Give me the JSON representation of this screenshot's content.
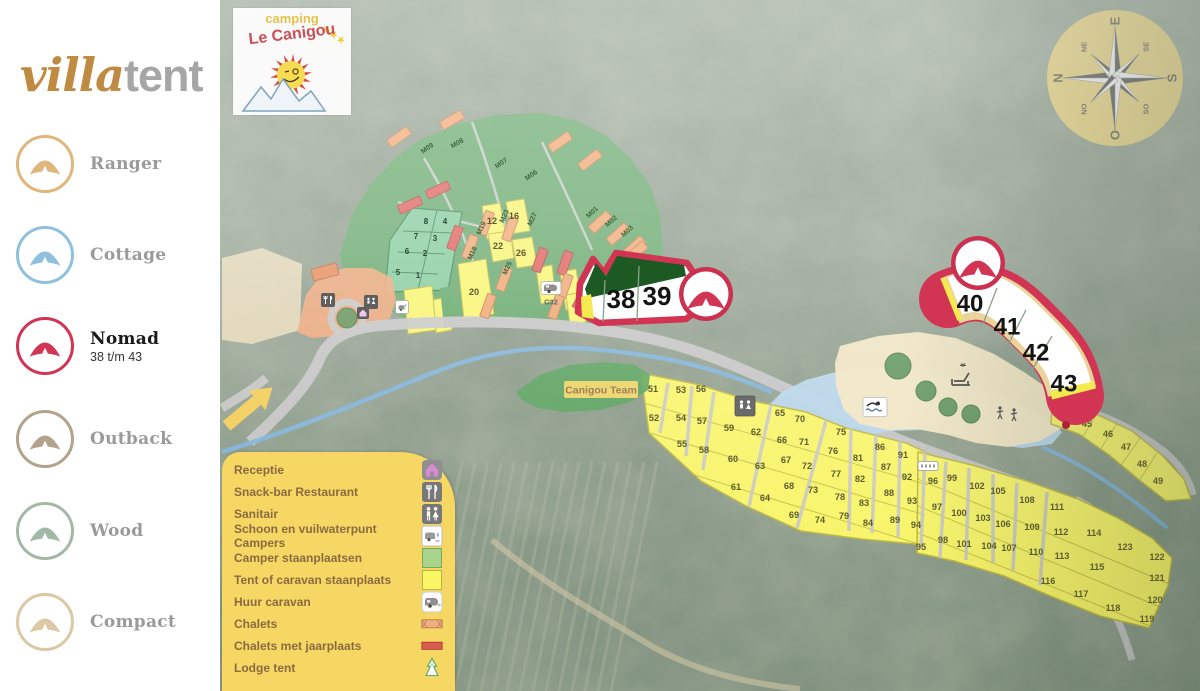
{
  "sidebar": {
    "logo": {
      "villa": "villa",
      "tent": "tent"
    },
    "items": [
      {
        "label": "Ranger",
        "color": "#dfb67c",
        "active": false,
        "sublabel": ""
      },
      {
        "label": "Cottage",
        "color": "#8fc0de",
        "active": false,
        "sublabel": ""
      },
      {
        "label": "Nomad",
        "color": "#d23553",
        "active": true,
        "sublabel": "38 t/m 43"
      },
      {
        "label": "Outback",
        "color": "#b3a28c",
        "active": false,
        "sublabel": ""
      },
      {
        "label": "Wood",
        "color": "#a2b9a7",
        "active": false,
        "sublabel": ""
      },
      {
        "label": "Compact",
        "color": "#dcc8a5",
        "active": false,
        "sublabel": ""
      }
    ]
  },
  "legend": {
    "items": [
      {
        "label": "Receptie",
        "icon": "house"
      },
      {
        "label": "Snack-bar Restaurant",
        "icon": "cutlery"
      },
      {
        "label": "Sanitair",
        "icon": "wc"
      },
      {
        "label": "Schoon en vuilwaterpunt Campers",
        "icon": "camper-service"
      },
      {
        "label": "Camper staanplaatsen",
        "icon": "green-swatch",
        "color": "#a9d48b"
      },
      {
        "label": "Tent of caravan staanplaats",
        "icon": "yellow-swatch",
        "color": "#f8f664"
      },
      {
        "label": "Huur caravan",
        "icon": "caravan"
      },
      {
        "label": "Chalets",
        "icon": "chalet",
        "color": "#f0b084"
      },
      {
        "label": "Chalets met jaarplaats",
        "icon": "chalet-red",
        "color": "#d95b4f"
      },
      {
        "label": "Lodge tent",
        "icon": "lodge"
      }
    ]
  },
  "map_logo": {
    "top": "camping",
    "name": "Le Canigou",
    "stars": "★★★"
  },
  "compass": {
    "cardinals": [
      "N",
      "E",
      "S",
      "O"
    ],
    "diagonals": [
      "NE",
      "SE",
      "SO",
      "NO"
    ]
  },
  "map": {
    "accent_red": "#d23553",
    "canigou_team_label": "Canigou Team",
    "caravan_label": "C32",
    "highlight_plots": [
      {
        "n": "38",
        "x": 621,
        "y": 299
      },
      {
        "n": "39",
        "x": 657,
        "y": 296
      },
      {
        "n": "40",
        "x": 970,
        "y": 303
      },
      {
        "n": "41",
        "x": 1007,
        "y": 326
      },
      {
        "n": "42",
        "x": 1036,
        "y": 352
      },
      {
        "n": "43",
        "x": 1064,
        "y": 383
      }
    ],
    "green_plots": [
      {
        "n": "1",
        "x": 418,
        "y": 275
      },
      {
        "n": "2",
        "x": 425,
        "y": 253
      },
      {
        "n": "3",
        "x": 435,
        "y": 238
      },
      {
        "n": "4",
        "x": 445,
        "y": 221
      },
      {
        "n": "5",
        "x": 398,
        "y": 272
      },
      {
        "n": "6",
        "x": 407,
        "y": 251
      },
      {
        "n": "7",
        "x": 416,
        "y": 236
      },
      {
        "n": "8",
        "x": 426,
        "y": 221
      }
    ],
    "yellow_plots": [
      {
        "n": "12",
        "x": 492,
        "y": 221
      },
      {
        "n": "16",
        "x": 514,
        "y": 216
      },
      {
        "n": "20",
        "x": 474,
        "y": 292
      },
      {
        "n": "22",
        "x": 498,
        "y": 246
      },
      {
        "n": "26",
        "x": 521,
        "y": 253
      },
      {
        "n": "45",
        "x": 1087,
        "y": 424
      },
      {
        "n": "46",
        "x": 1108,
        "y": 434
      },
      {
        "n": "47",
        "x": 1126,
        "y": 447
      },
      {
        "n": "48",
        "x": 1142,
        "y": 464
      },
      {
        "n": "49",
        "x": 1158,
        "y": 481
      },
      {
        "n": "51",
        "x": 653,
        "y": 389
      },
      {
        "n": "52",
        "x": 654,
        "y": 418
      },
      {
        "n": "53",
        "x": 681,
        "y": 390
      },
      {
        "n": "54",
        "x": 681,
        "y": 418
      },
      {
        "n": "55",
        "x": 682,
        "y": 444
      },
      {
        "n": "56",
        "x": 701,
        "y": 389
      },
      {
        "n": "57",
        "x": 702,
        "y": 421
      },
      {
        "n": "58",
        "x": 704,
        "y": 450
      },
      {
        "n": "59",
        "x": 729,
        "y": 428
      },
      {
        "n": "60",
        "x": 733,
        "y": 459
      },
      {
        "n": "61",
        "x": 736,
        "y": 487
      },
      {
        "n": "62",
        "x": 756,
        "y": 432
      },
      {
        "n": "63",
        "x": 760,
        "y": 466
      },
      {
        "n": "64",
        "x": 765,
        "y": 498
      },
      {
        "n": "65",
        "x": 780,
        "y": 413
      },
      {
        "n": "66",
        "x": 782,
        "y": 440
      },
      {
        "n": "67",
        "x": 786,
        "y": 460
      },
      {
        "n": "68",
        "x": 789,
        "y": 486
      },
      {
        "n": "69",
        "x": 794,
        "y": 515
      },
      {
        "n": "70",
        "x": 800,
        "y": 419
      },
      {
        "n": "71",
        "x": 804,
        "y": 442
      },
      {
        "n": "72",
        "x": 807,
        "y": 466
      },
      {
        "n": "73",
        "x": 813,
        "y": 490
      },
      {
        "n": "74",
        "x": 820,
        "y": 520
      },
      {
        "n": "75",
        "x": 841,
        "y": 432
      },
      {
        "n": "76",
        "x": 833,
        "y": 451
      },
      {
        "n": "77",
        "x": 836,
        "y": 474
      },
      {
        "n": "78",
        "x": 840,
        "y": 497
      },
      {
        "n": "79",
        "x": 844,
        "y": 516
      },
      {
        "n": "81",
        "x": 858,
        "y": 458
      },
      {
        "n": "82",
        "x": 860,
        "y": 479
      },
      {
        "n": "83",
        "x": 864,
        "y": 503
      },
      {
        "n": "84",
        "x": 868,
        "y": 523
      },
      {
        "n": "86",
        "x": 880,
        "y": 447
      },
      {
        "n": "87",
        "x": 886,
        "y": 467
      },
      {
        "n": "88",
        "x": 889,
        "y": 493
      },
      {
        "n": "89",
        "x": 895,
        "y": 520
      },
      {
        "n": "91",
        "x": 903,
        "y": 455
      },
      {
        "n": "92",
        "x": 907,
        "y": 477
      },
      {
        "n": "93",
        "x": 912,
        "y": 501
      },
      {
        "n": "94",
        "x": 916,
        "y": 525
      },
      {
        "n": "95",
        "x": 921,
        "y": 547
      },
      {
        "n": "96",
        "x": 933,
        "y": 481
      },
      {
        "n": "97",
        "x": 937,
        "y": 507
      },
      {
        "n": "98",
        "x": 943,
        "y": 540
      },
      {
        "n": "99",
        "x": 952,
        "y": 478
      },
      {
        "n": "100",
        "x": 959,
        "y": 513
      },
      {
        "n": "101",
        "x": 964,
        "y": 544
      },
      {
        "n": "102",
        "x": 977,
        "y": 486
      },
      {
        "n": "103",
        "x": 983,
        "y": 518
      },
      {
        "n": "104",
        "x": 989,
        "y": 546
      },
      {
        "n": "105",
        "x": 998,
        "y": 491
      },
      {
        "n": "106",
        "x": 1003,
        "y": 524
      },
      {
        "n": "107",
        "x": 1009,
        "y": 548
      },
      {
        "n": "108",
        "x": 1027,
        "y": 500
      },
      {
        "n": "109",
        "x": 1032,
        "y": 527
      },
      {
        "n": "110",
        "x": 1036,
        "y": 552
      },
      {
        "n": "111",
        "x": 1057,
        "y": 507
      },
      {
        "n": "112",
        "x": 1061,
        "y": 532
      },
      {
        "n": "113",
        "x": 1062,
        "y": 556
      },
      {
        "n": "114",
        "x": 1094,
        "y": 533
      },
      {
        "n": "115",
        "x": 1097,
        "y": 567
      },
      {
        "n": "116",
        "x": 1048,
        "y": 581
      },
      {
        "n": "117",
        "x": 1081,
        "y": 594
      },
      {
        "n": "118",
        "x": 1113,
        "y": 608
      },
      {
        "n": "119",
        "x": 1147,
        "y": 619
      },
      {
        "n": "120",
        "x": 1155,
        "y": 600
      },
      {
        "n": "121",
        "x": 1157,
        "y": 578
      },
      {
        "n": "122",
        "x": 1157,
        "y": 557
      },
      {
        "n": "123",
        "x": 1125,
        "y": 547
      }
    ],
    "m_labels": [
      {
        "t": "M09",
        "x": 427,
        "y": 148,
        "r": -35
      },
      {
        "t": "M08",
        "x": 457,
        "y": 143,
        "r": -30
      },
      {
        "t": "M07",
        "x": 501,
        "y": 163,
        "r": -35
      },
      {
        "t": "M06",
        "x": 531,
        "y": 175,
        "r": -35
      },
      {
        "t": "M01",
        "x": 592,
        "y": 212,
        "r": -42
      },
      {
        "t": "M02",
        "x": 611,
        "y": 221,
        "r": -42
      },
      {
        "t": "M03",
        "x": 627,
        "y": 231,
        "r": -42
      },
      {
        "t": "M19",
        "x": 481,
        "y": 228,
        "r": -65
      },
      {
        "t": "M23",
        "x": 504,
        "y": 216,
        "r": -65
      },
      {
        "t": "M27",
        "x": 532,
        "y": 219,
        "r": -65
      },
      {
        "t": "M18",
        "x": 472,
        "y": 253,
        "r": -65
      },
      {
        "t": "M25",
        "x": 507,
        "y": 268,
        "r": -65
      }
    ]
  }
}
